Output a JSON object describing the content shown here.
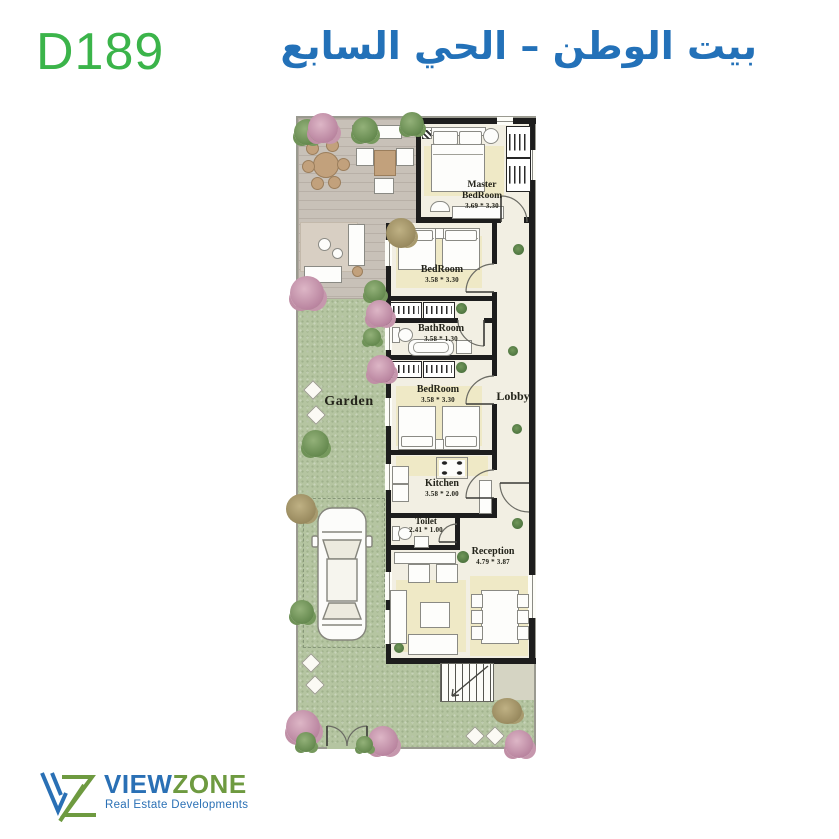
{
  "header": {
    "unit_code": "D189",
    "title_ar": "بيت الوطن – الحي السابع"
  },
  "plan": {
    "garden_label": "Garden",
    "lobby_label": "Lobby",
    "rooms": {
      "master": {
        "name": "Master BedRoom",
        "dims": "3.69 * 3.30"
      },
      "bedroom1": {
        "name": "BedRoom",
        "dims": "3.58 * 3.30"
      },
      "bathroom": {
        "name": "BathRoom",
        "dims": "3.58 * 1.30"
      },
      "bedroom2": {
        "name": "BedRoom",
        "dims": "3.58 * 3.30"
      },
      "kitchen": {
        "name": "Kitchen",
        "dims": "3.58 * 2.00"
      },
      "toilet": {
        "name": "Toilet",
        "dims": "2.41 * 1.00"
      },
      "reception": {
        "name": "Reception",
        "dims": "4.79 * 3.87"
      }
    }
  },
  "footer": {
    "brand_primary": "VIEW",
    "brand_secondary": "ZONE",
    "tagline": "Real Estate Developments"
  },
  "colors": {
    "unit_code_green": "#3bb44a",
    "title_blue": "#2371b8",
    "logo_blue": "#2a70b5",
    "logo_green": "#6e9a40",
    "garden_green": "#b5c5a1",
    "deck_gray": "#c8c1b8",
    "floor_cream": "#f2efe3",
    "rug_yellow": "#efe9c6",
    "wall_black": "#1d1d1d"
  }
}
